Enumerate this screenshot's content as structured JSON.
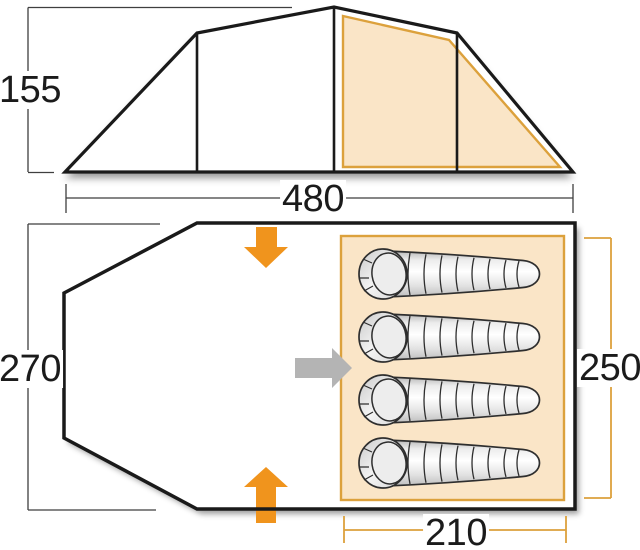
{
  "diagram": {
    "type": "tent-dimension-diagram",
    "side_view": {
      "height_label": "155",
      "width_label": "480"
    },
    "floor_plan": {
      "outer_depth_label": "270",
      "bedroom_depth_label": "250",
      "bedroom_width_label": "210",
      "sleeping_bag_count": 4,
      "door_arrows": [
        "down",
        "up"
      ],
      "inner_door_arrow": "right"
    }
  },
  "colors": {
    "outline": "#1a1a1a",
    "dim-line": "#3f3f3f",
    "accent-orange": "#F0941D",
    "tan": "#DCA13C",
    "peach": "#FAE5C7",
    "arrow-gray": "#B4B4B4",
    "bag-stroke": "#2e2e2e",
    "label-color": "#1b1b1b",
    "page-bg": "#ffffff"
  }
}
